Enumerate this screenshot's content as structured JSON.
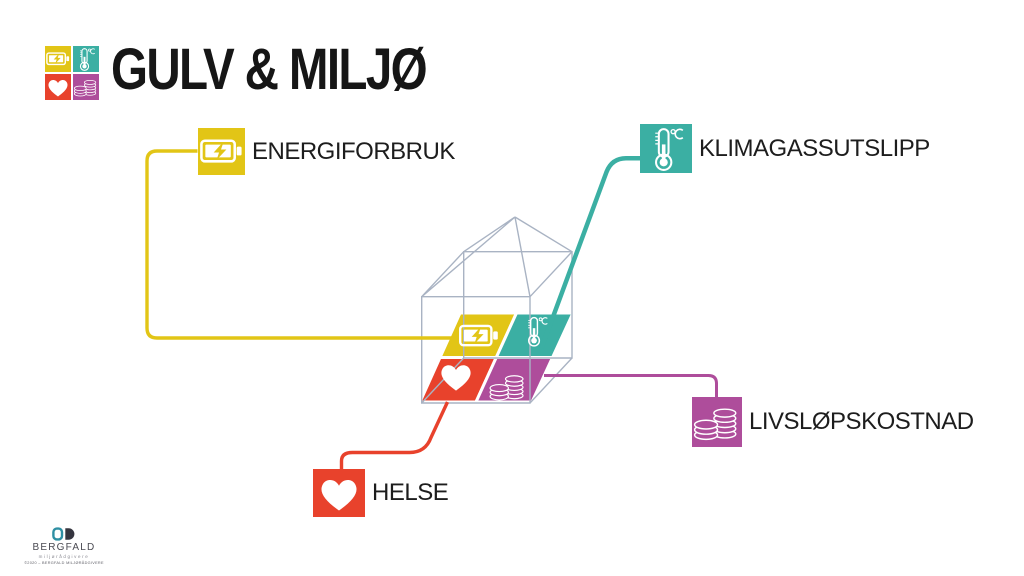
{
  "header": {
    "title": "GULV & MILJØ"
  },
  "nodes": {
    "energy": {
      "label": "ENERGIFORBRUK",
      "icon": "battery-icon"
    },
    "climate": {
      "label": "KLIMAGASSUTSLIPP",
      "icon": "thermometer-icon"
    },
    "cost": {
      "label": "LIVSLØPSKOSTNAD",
      "icon": "coins-icon"
    },
    "health": {
      "label": "HELSE",
      "icon": "heart-icon"
    }
  },
  "colors": {
    "energy": "#E2C516",
    "climate": "#3BAFA3",
    "health": "#E8422C",
    "cost": "#AE4D9B",
    "wire": "#A9B3C3",
    "text": "#1D1D1D"
  },
  "footer": {
    "company": "BERGFALD",
    "tagline": "miljørådgivere",
    "note": "©2020 – BERGFALD MILJØRÅDGIVERE"
  }
}
